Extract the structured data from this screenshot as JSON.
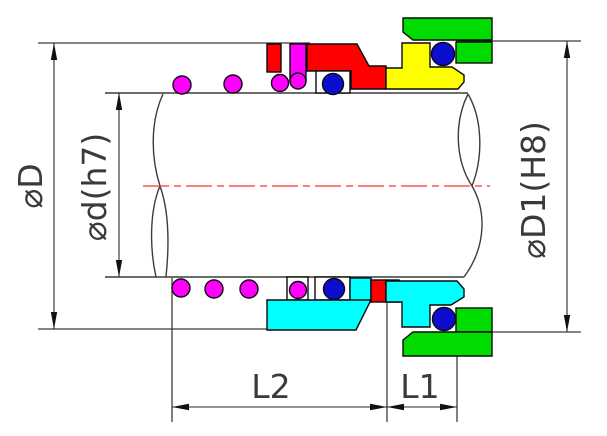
{
  "drawing": {
    "type": "mechanical-seal-cross-section",
    "labels": {
      "dia_outer": "⌀D",
      "dia_shaft": "⌀d(h7)",
      "dia_seat": "⌀D1(H8)",
      "len_l2": "L2",
      "len_l1": "L1"
    },
    "colors": {
      "red": "#ff0000",
      "magenta": "#ff00ff",
      "blue": "#0d0dd0",
      "yellow": "#ffff00",
      "green": "#00dc00",
      "cyan": "#00ffff",
      "white": "#ffffff",
      "outline": "#0a0a0a",
      "line": "#3c3c3c",
      "centerline": "#ff3232",
      "text": "#3a3a3a"
    }
  }
}
